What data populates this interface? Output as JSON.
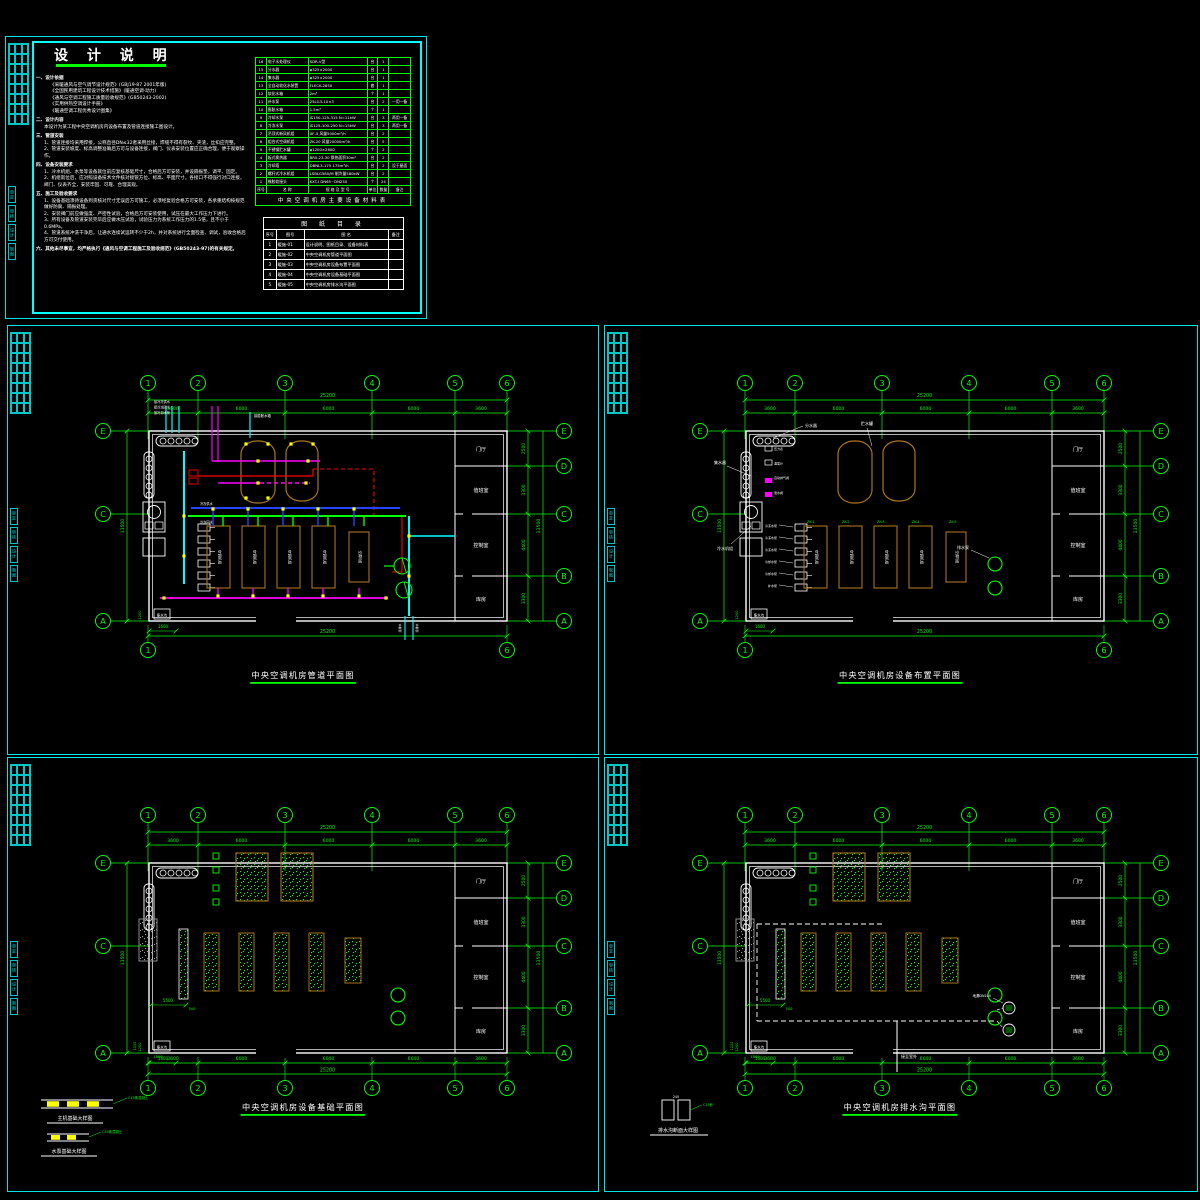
{
  "notes": {
    "title": "设 计 说 明",
    "lines": [
      [
        0,
        "一、设计依据"
      ],
      [
        1,
        "《采暖通风与空气调节设计规范》(GBJ19-87 2001年版)"
      ],
      [
        1,
        "《全国民用建筑工程设计技术措施》(暖通空调·动力)"
      ],
      [
        1,
        "《通风与空调工程施工质量验收规范》(GB50243-2002)"
      ],
      [
        1,
        "《实用供热空调设计手册》"
      ],
      [
        1,
        "《暖通空调工程优秀设计图集》"
      ],
      [
        0,
        "二、设计内容"
      ],
      [
        2,
        "本设计为某工程中央空调机房内设备布置及管道连接施工图设计。"
      ],
      [
        0,
        "三、管道安装"
      ],
      [
        2,
        "1、管道连接均采用焊接，公称直径DN≤32者采用丝接，焊缝不得有裂纹、夹渣，丝扣应完整。"
      ],
      [
        2,
        "2、管道安装坡度、标高调整准确后方可与设备连接，阀门、仪表安装位置应正确合理，便于观察操作。"
      ],
      [
        0,
        "四、设备安装要求"
      ],
      [
        2,
        "1、冷水机组、水泵等设备就位前应复核基础尺寸，合格后方可安装，并设隔振垫，调平、固定。"
      ],
      [
        2,
        "2、机组就位后，应对照设备技术文件核对接管方位、标高、平面尺寸，各接口不得强行对口连接，阀门、仪表齐全，安装牢固、可靠、合理美观。"
      ],
      [
        0,
        "五、施工及验收要求"
      ],
      [
        2,
        "1、设备基础须待设备到货核对尺寸无误后方可施工，必须经复验合格方可安装，各承重结构按规范做好防腐、隔振处理。"
      ],
      [
        2,
        "2、安装阀门前应做强度、严密性试验，合格后方可安装使用，试压在最大工作压力下进行。"
      ],
      [
        2,
        "3、所有设备及管道安装完毕后应做水压试验，试验压力为系统工作压力的1.5倍，且不小于0.6MPa。"
      ],
      [
        2,
        "4、管道系统冲洗干净后，让通水连续试运转不少于2h，并对系统进行全面检查、调试，验收合格后方可交付使用。"
      ],
      [
        0,
        "六、其他未尽事宜，均严格执行《通风与空调工程施工及验收规范》(GB50243-97)的有关规定。"
      ]
    ],
    "equipment_table": {
      "caption": "中央空调机房主要设备材料表",
      "columns": [
        "序号",
        "名  称",
        "规 格 及 型 号",
        "单位",
        "数量",
        "备注"
      ],
      "rows": [
        [
          "16",
          "电子水处理仪",
          "SDR-Ⅴ型",
          "台",
          "1",
          ""
        ],
        [
          "15",
          "分水器",
          "φ325×2000",
          "台",
          "1",
          ""
        ],
        [
          "14",
          "集水器",
          "φ325×2000",
          "台",
          "1",
          ""
        ],
        [
          "13",
          "全自动软化水装置",
          "FLECK-2850",
          "套",
          "1",
          ""
        ],
        [
          "12",
          "软化水箱",
          "2m³",
          "个",
          "1",
          ""
        ],
        [
          "11",
          "补水泵",
          "25LG3-10×3",
          "台",
          "2",
          "一用一备"
        ],
        [
          "10",
          "膨胀水箱",
          "1.5m³",
          "个",
          "1",
          ""
        ],
        [
          "9",
          "冷却水泵",
          "IS150-125-315  N=11kW",
          "台",
          "3",
          "两用一备"
        ],
        [
          "8",
          "冷冻水泵",
          "IS125-100-250  N=15kW",
          "台",
          "3",
          "两用一备"
        ],
        [
          "7",
          "吊顶式新风机组",
          "XF-5  风量5000m³/h",
          "台",
          "2",
          ""
        ],
        [
          "6",
          "组合式空调机组",
          "ZK-20  风量20000m³/h",
          "台",
          "5",
          ""
        ],
        [
          "5",
          "不锈钢贮水罐",
          "φ1200×2600",
          "个",
          "2",
          ""
        ],
        [
          "4",
          "板式换热器",
          "BR0.23-30  换热面积30m²",
          "台",
          "2",
          ""
        ],
        [
          "3",
          "冷却塔",
          "DBNL3-175  175m³/h",
          "台",
          "2",
          "设于屋面"
        ],
        [
          "2",
          "螺杆式冷水机组",
          "LSBLG580/M  制冷量580kW",
          "台",
          "2",
          ""
        ],
        [
          "1",
          "橡胶软接头",
          "KXT-Ⅰ  DN65~DN250",
          "个",
          "24",
          ""
        ]
      ]
    },
    "drawing_list": {
      "caption": "图 纸 目 录",
      "columns": [
        "序号",
        "图号",
        "图    名",
        "备注"
      ],
      "rows": [
        [
          "1",
          "暖施-01",
          "设计说明、图纸目录、设备材料表",
          ""
        ],
        [
          "2",
          "暖施-02",
          "中央空调机房管道平面图",
          ""
        ],
        [
          "3",
          "暖施-03",
          "中央空调机房设备布置平面图",
          ""
        ],
        [
          "4",
          "暖施-04",
          "中央空调机房设备基础平面图",
          ""
        ],
        [
          "5",
          "暖施-05",
          "中央空调机房排水沟平面图",
          ""
        ]
      ]
    }
  },
  "grid": {
    "cols": [
      "1",
      "2",
      "3",
      "4",
      "5",
      "6"
    ],
    "col_dims": [
      "3600",
      "6000",
      "6000",
      "6000",
      "3600"
    ],
    "col_total": "25200",
    "rows": [
      "E",
      "D",
      "C",
      "B",
      "A"
    ],
    "left_rows": [
      "E",
      "C",
      "A"
    ],
    "row_dims": [
      "2500",
      "3300",
      "4400",
      "3300"
    ],
    "row_total": "13500"
  },
  "rooms": [
    "门厅",
    "值班室",
    "控制室",
    "库房"
  ],
  "labels": {
    "ahu": "空调机组",
    "sump": "集水坑",
    "dim_1600": "1600",
    "dim_1200": "1200",
    "main_supply": "冷冻供水",
    "main_return": "冷冻回水",
    "drain_tag": "接排水"
  },
  "plans": [
    {
      "id": "piping",
      "title": "中央空调机房管道平面图",
      "riser_labels": [
        "接冷冻供水",
        "接冷冻回水",
        "接冷却水管"
      ],
      "tank_feed_label": "接膨胀水箱"
    },
    {
      "id": "equipment",
      "title": "中央空调机房设备布置平面图",
      "labels": {
        "collector_h": "分水器",
        "collector_v": "集水器",
        "chiller": "冷水机组",
        "tanks": "贮水罐",
        "pumps": "排水泵",
        "ahu_tag": "ZK"
      },
      "pump_rows": [
        "冷冻水泵",
        "冷冻水泵",
        "冷冻水泵",
        "冷却水泵",
        "冷却水泵",
        "补水泵"
      ],
      "tag_texts": [
        "压力表",
        "温度计",
        "自动排气阀",
        "泄水阀"
      ]
    },
    {
      "id": "foundation",
      "title": "中央空调机房设备基础平面图",
      "dims": {
        "d5500": "5500",
        "d500": "500",
        "d1200": "1200",
        "d1800": "1800"
      },
      "details": [
        {
          "title": "主机基础大样图",
          "note": "C15素混凝土"
        },
        {
          "title": "水泵基础大样图",
          "note": "C15素混凝土"
        }
      ]
    },
    {
      "id": "drainage",
      "title": "中央空调机房排水沟平面图",
      "outlet_label": "接至室外",
      "drain_label": "地漏DN100",
      "detail": {
        "title": "排水沟断面大样图",
        "note": "C15砼",
        "dim": "240"
      }
    }
  ],
  "strip_labels": [
    "审定",
    "审核",
    "设计",
    "制图"
  ],
  "colors": {
    "frame": "#00ffff",
    "grid": "#00ff00",
    "wall": "#ffffff",
    "equip_outline": "#a8761d",
    "pipe_chilled": "#2244ff",
    "pipe_cooling": "#ff00ff",
    "pipe_hot": "#ff0000",
    "pipe_water": "#00ffff",
    "valve": "#ffff00",
    "foundation_hatch": "#00ff00",
    "gray": "#9a9a9a"
  }
}
